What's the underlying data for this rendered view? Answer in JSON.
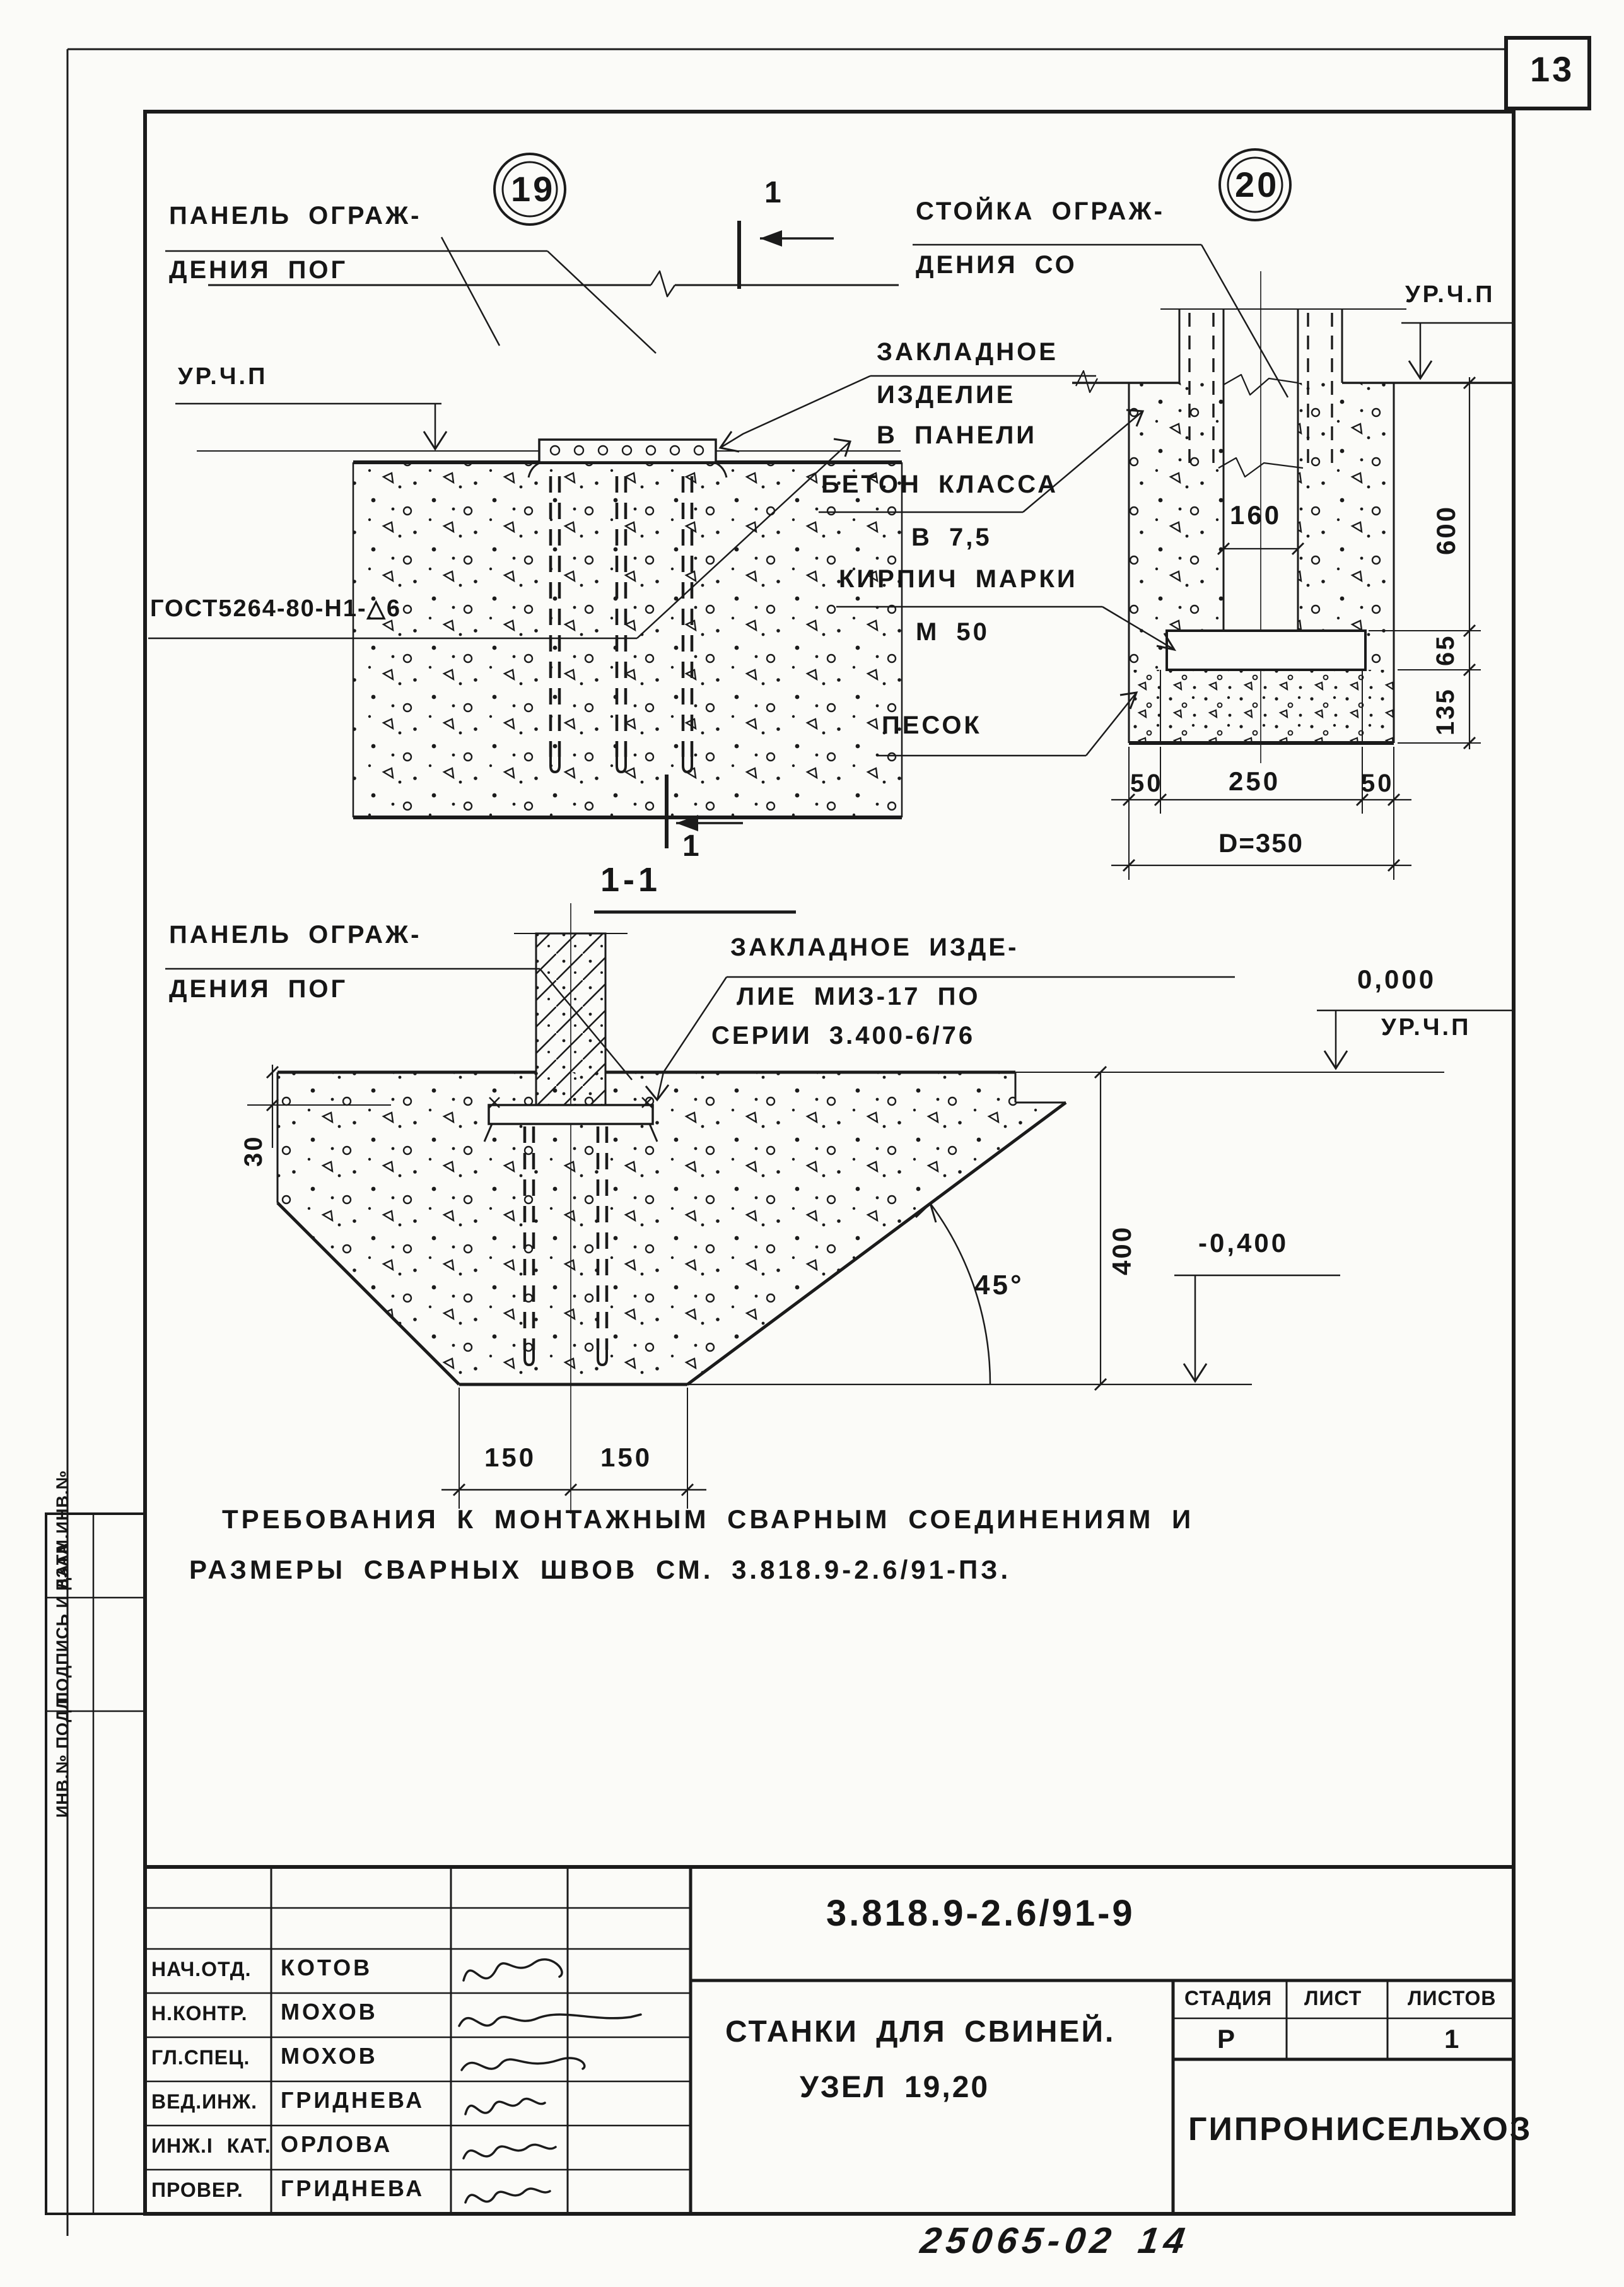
{
  "sheet": {
    "page_number": "13",
    "hand_note": "25065-02   14"
  },
  "margin": {
    "label_top": "ВЗАМ.ИНВ.№",
    "label_mid": "ПОДПИСЬ И ДАТА",
    "label_bot": "ИНВ.№ ПОДЛ."
  },
  "d19": {
    "num": "19",
    "cut_label": "1",
    "panel_l1": "ПАНЕЛЬ ОГРАЖ-",
    "panel_l2": "ДЕНИЯ ПОГ",
    "level": "УР.Ч.П",
    "weld": "ГОСТ5264-80-Н1-△6",
    "emb_l1": "ЗАКЛАДНОЕ",
    "emb_l2": "ИЗДЕЛИЕ",
    "emb_l3": "В ПАНЕЛИ"
  },
  "d20": {
    "num": "20",
    "post_l1": "СТОЙКА ОГРАЖ-",
    "post_l2": "ДЕНИЯ СО",
    "level": "УР.Ч.П",
    "conc_l1": "БЕТОН КЛАССА",
    "conc_l2": "В 7,5",
    "brick_l1": "КИРПИЧ МАРКИ",
    "brick_l2": "М 50",
    "sand": "ПЕСОК",
    "dims": {
      "w160": "160",
      "h600": "600",
      "h65": "65",
      "h135": "135",
      "b50l": "50",
      "b250": "250",
      "b50r": "50",
      "d350": "D=350"
    }
  },
  "s11": {
    "title": "1-1",
    "panel_l1": "ПАНЕЛЬ ОГРАЖ-",
    "panel_l2": "ДЕНИЯ ПОГ",
    "emb_l1": "ЗАКЛАДНОЕ ИЗДЕ-",
    "emb_l2": "ЛИЕ МИЗ-17 ПО",
    "emb_l3": "СЕРИИ 3.400-6/76",
    "zero": "0,000",
    "level": "УР.Ч.П",
    "neg": "-0,400",
    "dims": {
      "t30": "30",
      "h400": "400",
      "a45": "45°",
      "b150l": "150",
      "b150r": "150"
    }
  },
  "note": {
    "line1": "ТРЕБОВАНИЯ   К   МОНТАЖНЫМ   СВАРНЫМ   СОЕДИНЕНИЯМ   И",
    "line2": "РАЗМЕРЫ   СВАРНЫХ   ШВОВ   СМ.  3.818.9-2.6/91-ПЗ."
  },
  "stamp": {
    "doc_number": "3.818.9-2.6/91-9",
    "title_l1": "СТАНКИ ДЛЯ СВИНЕЙ.",
    "title_l2": "УЗЕЛ 19,20",
    "stage_label": "СТАДИЯ",
    "sheet_label": "ЛИСТ",
    "sheets_label": "ЛИСТОВ",
    "stage": "Р",
    "sheets_count": "1",
    "org": "ГИПРОНИСЕЛЬХОЗ",
    "rows": [
      {
        "role": "НАЧ.ОТД.",
        "name": "КОТОВ"
      },
      {
        "role": "Н.КОНТР.",
        "name": "МОХОВ"
      },
      {
        "role": "ГЛ.СПЕЦ.",
        "name": "МОХОВ"
      },
      {
        "role": "ВЕД.ИНЖ.",
        "name": "ГРИДНЕВА"
      },
      {
        "role": "ИНЖ.I КАТ.",
        "name": "ОРЛОВА"
      },
      {
        "role": "ПРОВЕР.",
        "name": "ГРИДНЕВА"
      }
    ]
  }
}
